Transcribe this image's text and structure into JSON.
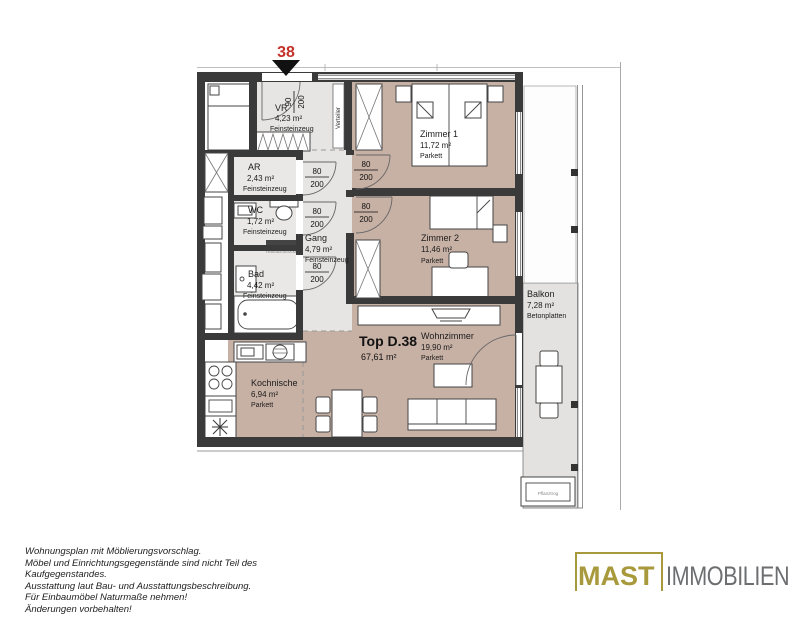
{
  "plan": {
    "unit_number": "38",
    "unit_label": "Top D.38",
    "unit_area": "67,61 m²",
    "rooms": {
      "vr": {
        "name": "VR",
        "area": "4,23 m²",
        "floor": "Feinsteinzeug"
      },
      "ar": {
        "name": "AR",
        "area": "2,43 m²",
        "floor": "Feinsteinzeug"
      },
      "wc": {
        "name": "WC",
        "area": "1,72 m²",
        "floor": "Feinsteinzeug"
      },
      "gang": {
        "name": "Gang",
        "area": "4,79 m²",
        "floor": "Feinsteinzeug"
      },
      "bad": {
        "name": "Bad",
        "area": "4,42 m²",
        "floor": "Feinsteinzeug"
      },
      "zimmer1": {
        "name": "Zimmer 1",
        "area": "11,72 m²",
        "floor": "Parkett"
      },
      "zimmer2": {
        "name": "Zimmer 2",
        "area": "11,46 m²",
        "floor": "Parkett"
      },
      "wohnzimmer": {
        "name": "Wohnzimmer",
        "area": "19,90 m²",
        "floor": "Parkett"
      },
      "kochnische": {
        "name": "Kochnische",
        "area": "6,94 m²",
        "floor": "Parkett"
      },
      "balkon": {
        "name": "Balkon",
        "area": "7,28 m²",
        "floor": "Betonplatten"
      }
    },
    "doors": {
      "entrance": {
        "w": "90",
        "h": "200"
      },
      "interior": {
        "w": "80",
        "h": "200"
      }
    },
    "labels": {
      "verteiler": "Verteiler",
      "pflanztrog": "Pflanztrog",
      "radiator": "Handtuchtrockner"
    }
  },
  "footer": {
    "disclaimer": [
      "Wohnungsplan mit Möblierungsvorschlag.",
      "Möbel und Einrichtungsgegenstände sind nicht Teil des",
      "Kaufgegenstandes.",
      "Ausstattung laut Bau- und Ausstattungsbeschreibung.",
      "Für Einbaumöbel Naturmaße nehmen!",
      "Änderungen vorbehalten!"
    ]
  },
  "logo": {
    "primary": "MAST",
    "secondary": "IMMOBILIEN",
    "color_primary": "#a89a3c",
    "color_secondary": "#6d6e70"
  },
  "colors": {
    "parkett_fill": "#c7b0a4",
    "tile_fill": "#e6e5e3",
    "balcony_fill": "#e3e2e0",
    "wall": "#3a3a3a",
    "unit_marker_red": "#c4312b"
  }
}
